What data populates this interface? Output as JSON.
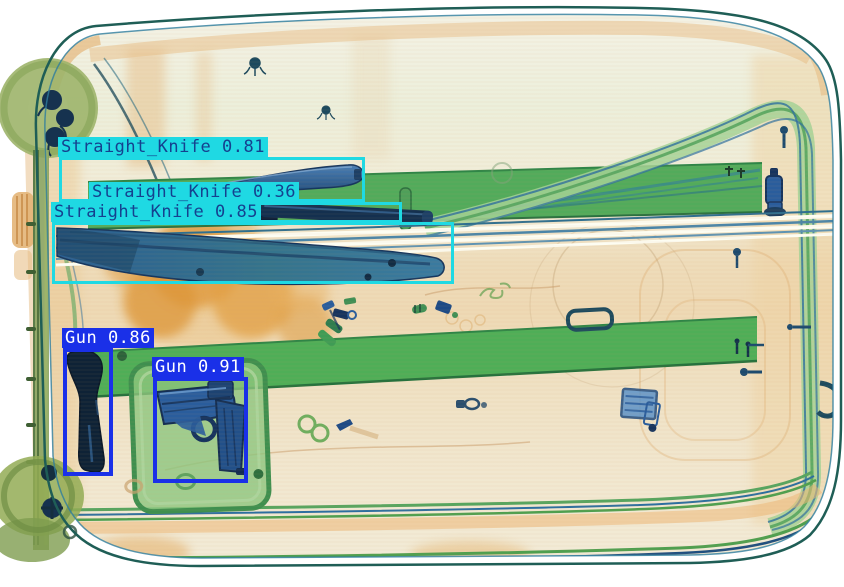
{
  "image": {
    "kind": "xray-baggage-scan-with-detections",
    "width": 844,
    "height": 587
  },
  "classes": {
    "knife": {
      "box_color": "#1fd9e3",
      "label_bg": "#1fd9e3",
      "text_color": "#15418f",
      "border_px": 3
    },
    "gun": {
      "box_color": "#1a30e8",
      "label_bg": "#1a30e8",
      "text_color": "#ffffff",
      "border_px": 4
    }
  },
  "detections": [
    {
      "label": "Straight_Knife",
      "score": "0.81",
      "class": "knife",
      "box": {
        "x": 59,
        "y": 157,
        "w": 306,
        "h": 45
      }
    },
    {
      "label": "Straight_Knife",
      "score": "0.36",
      "class": "knife",
      "box": {
        "x": 90,
        "y": 202,
        "w": 312,
        "h": 21
      }
    },
    {
      "label": "Straight_Knife",
      "score": "0.85",
      "class": "knife",
      "box": {
        "x": 52,
        "y": 222,
        "w": 402,
        "h": 62
      }
    },
    {
      "label": "Gun",
      "score": "0.86",
      "class": "gun",
      "box": {
        "x": 63,
        "y": 348,
        "w": 50,
        "h": 128
      }
    },
    {
      "label": "Gun",
      "score": "0.91",
      "class": "gun",
      "box": {
        "x": 153,
        "y": 377,
        "w": 95,
        "h": 106
      }
    }
  ]
}
